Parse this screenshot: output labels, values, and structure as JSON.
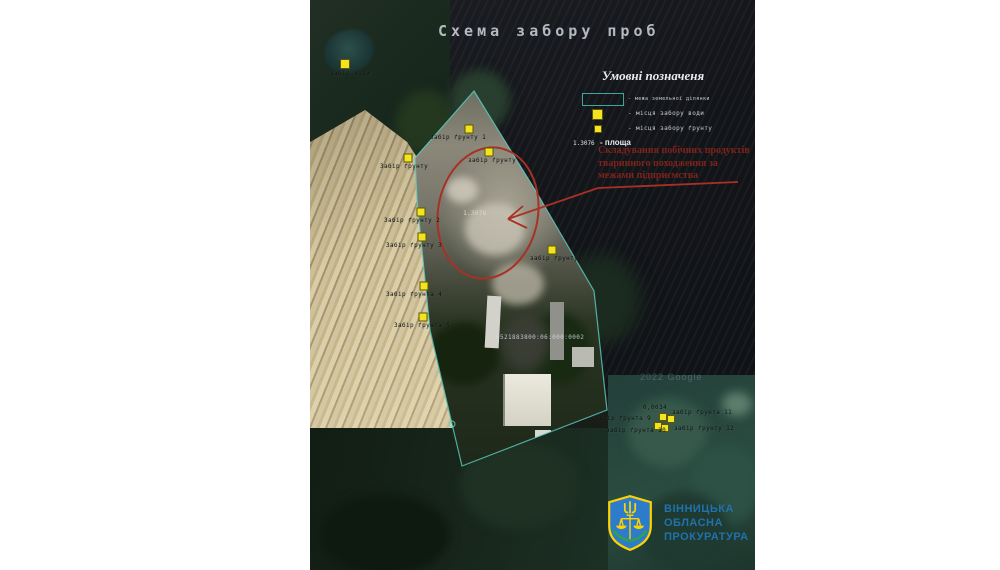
{
  "page": {
    "background": "#ffffff"
  },
  "map": {
    "title": "Схема забору проб",
    "watermark": "2022 Google",
    "cadastral_number": "0521883800:06:000:0002",
    "area_value": "1.3076",
    "legend": {
      "title": "Умовні позначеня",
      "items": [
        {
          "symbol": "boundary-rect",
          "label": "- межа земельної ділянки"
        },
        {
          "symbol": "yellow-square",
          "label": "- місця забору води"
        },
        {
          "symbol": "yellow-square-small",
          "label": "- місця забору ґрунту"
        },
        {
          "symbol": "area-value",
          "value": "1.3076",
          "label": "- площа"
        }
      ]
    },
    "annotation": {
      "lines": [
        "Складування побічних продуктів",
        "тваринного походження за",
        "межами підприємства"
      ]
    },
    "markers": [
      {
        "x": 35,
        "y": 64,
        "s": 8,
        "label": "Забір води",
        "lx": 20,
        "ly": 70
      },
      {
        "x": 159,
        "y": 129,
        "s": 7,
        "label": "Забір ґрунту 1",
        "lx": 120,
        "ly": 134
      },
      {
        "x": 179,
        "y": 152,
        "s": 7,
        "label": "забір ґрунту",
        "lx": 158,
        "ly": 157
      },
      {
        "x": 98,
        "y": 158,
        "s": 7,
        "label": "Забір ґрунту",
        "lx": 70,
        "ly": 163
      },
      {
        "x": 111,
        "y": 212,
        "s": 7,
        "label": "Забір ґрунту 2",
        "lx": 74,
        "ly": 217
      },
      {
        "x": 112,
        "y": 237,
        "s": 7,
        "label": "Забір ґрунту 3",
        "lx": 76,
        "ly": 242
      },
      {
        "x": 242,
        "y": 250,
        "s": 7,
        "label": "забір ґрунту 8",
        "lx": 220,
        "ly": 255
      },
      {
        "x": 114,
        "y": 286,
        "s": 7,
        "label": "Забір ґрунта 4",
        "lx": 76,
        "ly": 291
      },
      {
        "x": 113,
        "y": 317,
        "s": 7,
        "label": "Забір ґрунта 5",
        "lx": 84,
        "ly": 322
      },
      {
        "x": 353,
        "y": 417,
        "s": 6
      },
      {
        "x": 361,
        "y": 419,
        "s": 6
      },
      {
        "x": 348,
        "y": 426,
        "s": 6
      },
      {
        "x": 355,
        "y": 428,
        "s": 6
      }
    ],
    "extra_labels": [
      {
        "text": "0,0034",
        "x": 333,
        "y": 404
      },
      {
        "text": "забір ґрунта 11",
        "x": 362,
        "y": 409
      },
      {
        "text": "- забір ґрунта 9",
        "x": 277,
        "y": 415
      },
      {
        "text": "забір ґрунта 10",
        "x": 296,
        "y": 427
      },
      {
        "text": "забір ґрунту 12",
        "x": 364,
        "y": 425
      }
    ],
    "colors": {
      "boundary": "#5ecfc6",
      "marker": "#f2e41f",
      "annotation_red": "#a83126",
      "title_gray": "#b4bac1"
    }
  },
  "logo": {
    "lines": [
      "ВІННИЦЬКА",
      "ОБЛАСНА",
      "ПРОКУРАТУРА"
    ],
    "text_color": "#2071ad"
  }
}
